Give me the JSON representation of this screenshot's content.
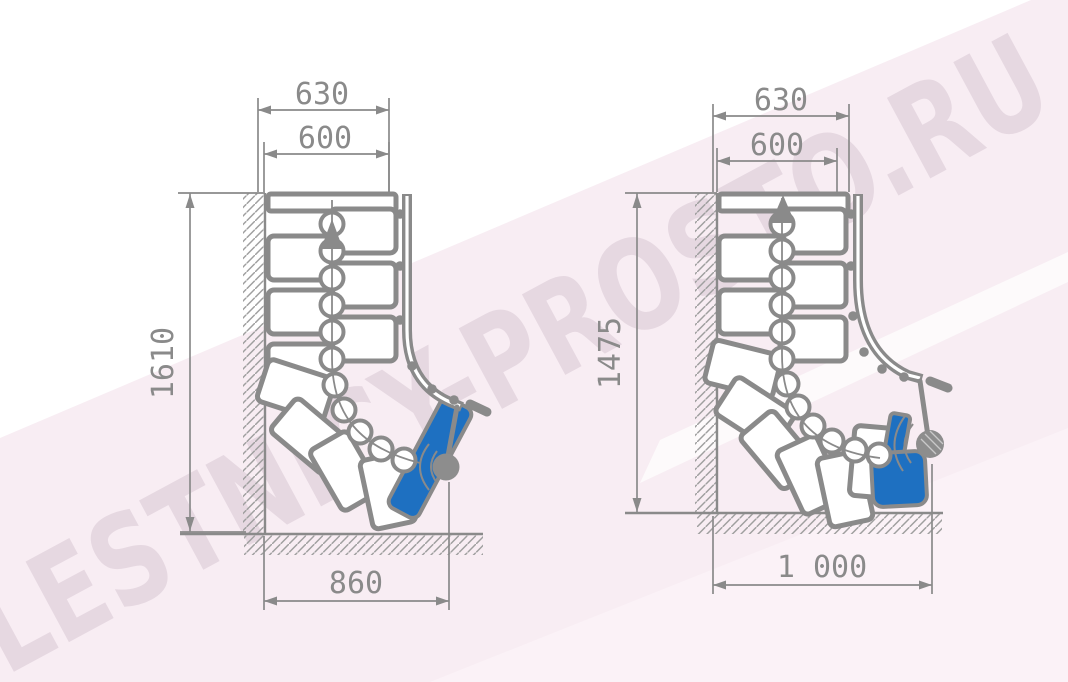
{
  "watermark": {
    "text": "LESTNICY-PROSTO.RU"
  },
  "colors": {
    "line": "#8a8a8a",
    "step_highlight": "#1e70c1",
    "background_tint": "#f8edf3",
    "watermark_text": "#e2d3dd"
  },
  "diagrams": {
    "left": {
      "dims": {
        "top_outer": "630",
        "top_inner": "600",
        "height": "1610",
        "width": "860"
      }
    },
    "right": {
      "dims": {
        "top_outer": "630",
        "top_inner": "600",
        "height": "1475",
        "width": "1 000"
      }
    }
  },
  "icons": {
    "walk_direction_arrow": "▲"
  }
}
